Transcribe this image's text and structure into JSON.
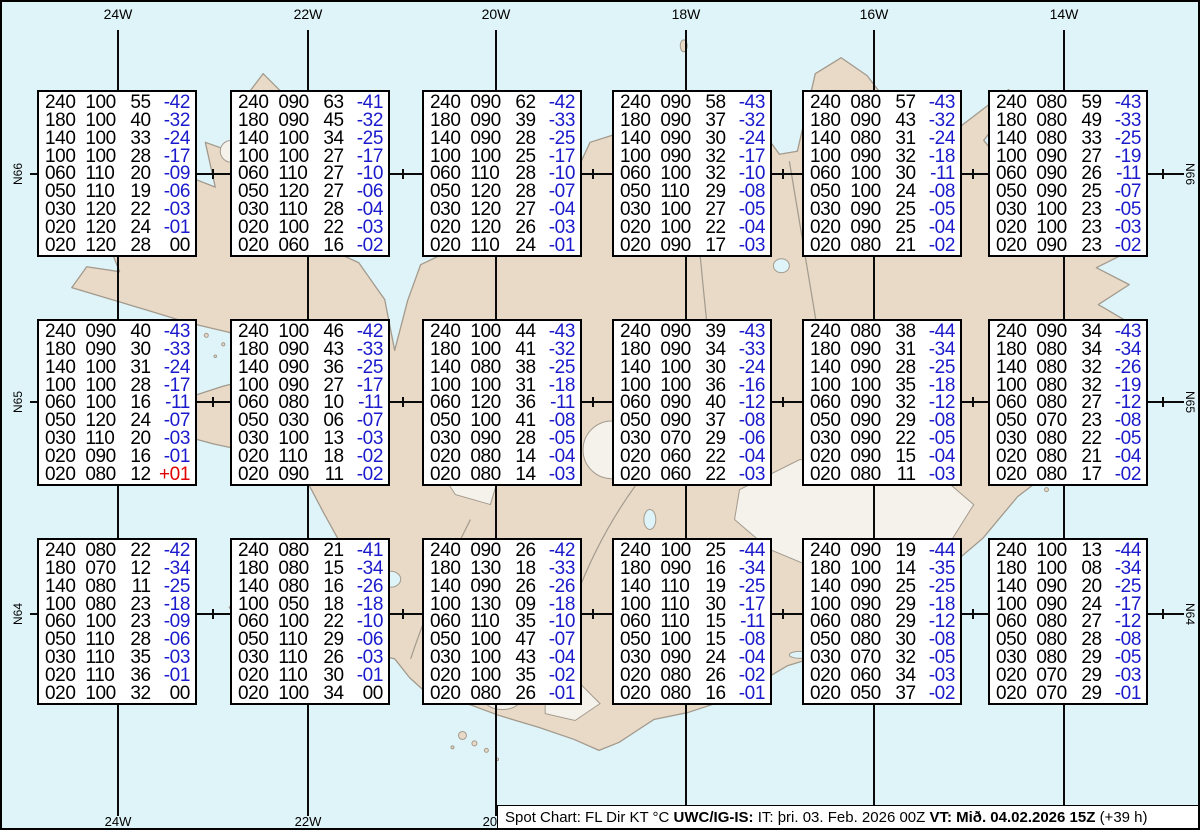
{
  "map": {
    "ocean_color": "#dff4f8",
    "land_color": "#e8dac6",
    "coast_color": "#a39a8e",
    "graticule_color": "#0a0a0a",
    "meridians": [
      {
        "label": "24W",
        "x": 116
      },
      {
        "label": "22W",
        "x": 306
      },
      {
        "label": "20W",
        "x": 494
      },
      {
        "label": "18W",
        "x": 684
      },
      {
        "label": "16W",
        "x": 872
      },
      {
        "label": "14W",
        "x": 1062
      }
    ],
    "parallels": [
      {
        "label": "N66",
        "y": 172
      },
      {
        "label": "N65",
        "y": 400
      },
      {
        "label": "N64",
        "y": 612
      }
    ],
    "parallel_tick_x": [
      57,
      211,
      401,
      591,
      781,
      971,
      1161
    ],
    "grid_col_x": [
      35,
      228,
      420,
      610,
      800,
      986
    ],
    "grid_row_y": [
      88,
      317,
      536
    ]
  },
  "colors": {
    "temp_negative": "#1a1acc",
    "temp_positive": "#e00000",
    "temp_zero": "#000000"
  },
  "footer": {
    "segments": [
      {
        "text": "Spot Chart: FL Dir KT °C ",
        "bold": false
      },
      {
        "text": "UWC/IG-IS: ",
        "bold": true
      },
      {
        "text": "IT: þri. 03. Feb. 2026 00Z ",
        "bold": false
      },
      {
        "text": "VT: Mið. 04.02.2026 15Z ",
        "bold": true
      },
      {
        "text": "(+39 h)",
        "bold": false
      }
    ]
  },
  "columns_meaning": [
    "FL",
    "Dir",
    "KT",
    "°C"
  ],
  "spot_boxes": [
    {
      "row": 0,
      "col": 0,
      "rows": [
        [
          "240",
          "100",
          "55",
          "-42"
        ],
        [
          "180",
          "100",
          "40",
          "-32"
        ],
        [
          "140",
          "100",
          "33",
          "-24"
        ],
        [
          "100",
          "100",
          "28",
          "-17"
        ],
        [
          "060",
          "110",
          "20",
          "-09"
        ],
        [
          "050",
          "110",
          "19",
          "-06"
        ],
        [
          "030",
          "120",
          "22",
          "-03"
        ],
        [
          "020",
          "120",
          "24",
          "-01"
        ],
        [
          "020",
          "120",
          "28",
          "00"
        ]
      ]
    },
    {
      "row": 0,
      "col": 1,
      "rows": [
        [
          "240",
          "090",
          "63",
          "-41"
        ],
        [
          "180",
          "090",
          "45",
          "-32"
        ],
        [
          "140",
          "100",
          "34",
          "-25"
        ],
        [
          "100",
          "100",
          "27",
          "-17"
        ],
        [
          "060",
          "110",
          "27",
          "-10"
        ],
        [
          "050",
          "120",
          "27",
          "-06"
        ],
        [
          "030",
          "110",
          "28",
          "-04"
        ],
        [
          "020",
          "100",
          "22",
          "-03"
        ],
        [
          "020",
          "060",
          "16",
          "-02"
        ]
      ]
    },
    {
      "row": 0,
      "col": 2,
      "rows": [
        [
          "240",
          "090",
          "62",
          "-42"
        ],
        [
          "180",
          "090",
          "39",
          "-33"
        ],
        [
          "140",
          "090",
          "28",
          "-25"
        ],
        [
          "100",
          "100",
          "25",
          "-17"
        ],
        [
          "060",
          "110",
          "28",
          "-10"
        ],
        [
          "050",
          "120",
          "28",
          "-07"
        ],
        [
          "030",
          "120",
          "27",
          "-04"
        ],
        [
          "020",
          "120",
          "26",
          "-03"
        ],
        [
          "020",
          "110",
          "24",
          "-01"
        ]
      ]
    },
    {
      "row": 0,
      "col": 3,
      "rows": [
        [
          "240",
          "090",
          "58",
          "-43"
        ],
        [
          "180",
          "090",
          "37",
          "-32"
        ],
        [
          "140",
          "090",
          "30",
          "-24"
        ],
        [
          "100",
          "090",
          "32",
          "-17"
        ],
        [
          "060",
          "100",
          "32",
          "-10"
        ],
        [
          "050",
          "110",
          "29",
          "-08"
        ],
        [
          "030",
          "100",
          "27",
          "-05"
        ],
        [
          "020",
          "100",
          "22",
          "-04"
        ],
        [
          "020",
          "090",
          "17",
          "-03"
        ]
      ]
    },
    {
      "row": 0,
      "col": 4,
      "rows": [
        [
          "240",
          "080",
          "57",
          "-43"
        ],
        [
          "180",
          "090",
          "43",
          "-32"
        ],
        [
          "140",
          "080",
          "31",
          "-24"
        ],
        [
          "100",
          "090",
          "32",
          "-18"
        ],
        [
          "060",
          "100",
          "30",
          "-11"
        ],
        [
          "050",
          "100",
          "24",
          "-08"
        ],
        [
          "030",
          "090",
          "25",
          "-05"
        ],
        [
          "020",
          "090",
          "25",
          "-04"
        ],
        [
          "020",
          "080",
          "21",
          "-02"
        ]
      ]
    },
    {
      "row": 0,
      "col": 5,
      "rows": [
        [
          "240",
          "080",
          "59",
          "-43"
        ],
        [
          "180",
          "080",
          "49",
          "-33"
        ],
        [
          "140",
          "080",
          "33",
          "-25"
        ],
        [
          "100",
          "090",
          "27",
          "-19"
        ],
        [
          "060",
          "090",
          "26",
          "-11"
        ],
        [
          "050",
          "090",
          "25",
          "-07"
        ],
        [
          "030",
          "100",
          "23",
          "-05"
        ],
        [
          "020",
          "100",
          "23",
          "-03"
        ],
        [
          "020",
          "090",
          "23",
          "-02"
        ]
      ]
    },
    {
      "row": 1,
      "col": 0,
      "rows": [
        [
          "240",
          "090",
          "40",
          "-43"
        ],
        [
          "180",
          "090",
          "30",
          "-33"
        ],
        [
          "140",
          "100",
          "31",
          "-24"
        ],
        [
          "100",
          "100",
          "28",
          "-17"
        ],
        [
          "060",
          "100",
          "16",
          "-11"
        ],
        [
          "050",
          "120",
          "24",
          "-07"
        ],
        [
          "030",
          "110",
          "20",
          "-03"
        ],
        [
          "020",
          "090",
          "16",
          "-01"
        ],
        [
          "020",
          "080",
          "12",
          "+01"
        ]
      ]
    },
    {
      "row": 1,
      "col": 1,
      "rows": [
        [
          "240",
          "100",
          "46",
          "-42"
        ],
        [
          "180",
          "090",
          "43",
          "-33"
        ],
        [
          "140",
          "090",
          "36",
          "-25"
        ],
        [
          "100",
          "090",
          "27",
          "-17"
        ],
        [
          "060",
          "080",
          "10",
          "-11"
        ],
        [
          "050",
          "030",
          "06",
          "-07"
        ],
        [
          "030",
          "100",
          "13",
          "-03"
        ],
        [
          "020",
          "110",
          "18",
          "-02"
        ],
        [
          "020",
          "090",
          "11",
          "-02"
        ]
      ]
    },
    {
      "row": 1,
      "col": 2,
      "rows": [
        [
          "240",
          "100",
          "44",
          "-43"
        ],
        [
          "180",
          "100",
          "41",
          "-32"
        ],
        [
          "140",
          "080",
          "38",
          "-25"
        ],
        [
          "100",
          "100",
          "31",
          "-18"
        ],
        [
          "060",
          "120",
          "36",
          "-11"
        ],
        [
          "050",
          "100",
          "41",
          "-08"
        ],
        [
          "030",
          "090",
          "28",
          "-05"
        ],
        [
          "020",
          "080",
          "14",
          "-04"
        ],
        [
          "020",
          "080",
          "14",
          "-03"
        ]
      ]
    },
    {
      "row": 1,
      "col": 3,
      "rows": [
        [
          "240",
          "090",
          "39",
          "-43"
        ],
        [
          "180",
          "090",
          "34",
          "-33"
        ],
        [
          "140",
          "100",
          "30",
          "-24"
        ],
        [
          "100",
          "100",
          "36",
          "-16"
        ],
        [
          "060",
          "090",
          "40",
          "-12"
        ],
        [
          "050",
          "090",
          "37",
          "-08"
        ],
        [
          "030",
          "070",
          "29",
          "-06"
        ],
        [
          "020",
          "060",
          "22",
          "-04"
        ],
        [
          "020",
          "060",
          "22",
          "-03"
        ]
      ]
    },
    {
      "row": 1,
      "col": 4,
      "rows": [
        [
          "240",
          "080",
          "38",
          "-44"
        ],
        [
          "180",
          "090",
          "31",
          "-34"
        ],
        [
          "140",
          "090",
          "28",
          "-25"
        ],
        [
          "100",
          "100",
          "35",
          "-18"
        ],
        [
          "060",
          "090",
          "32",
          "-12"
        ],
        [
          "050",
          "090",
          "29",
          "-08"
        ],
        [
          "030",
          "090",
          "22",
          "-05"
        ],
        [
          "020",
          "090",
          "15",
          "-04"
        ],
        [
          "020",
          "080",
          "11",
          "-03"
        ]
      ]
    },
    {
      "row": 1,
      "col": 5,
      "rows": [
        [
          "240",
          "090",
          "34",
          "-43"
        ],
        [
          "180",
          "080",
          "34",
          "-34"
        ],
        [
          "140",
          "080",
          "32",
          "-26"
        ],
        [
          "100",
          "080",
          "32",
          "-19"
        ],
        [
          "060",
          "080",
          "27",
          "-12"
        ],
        [
          "050",
          "070",
          "23",
          "-08"
        ],
        [
          "030",
          "080",
          "22",
          "-05"
        ],
        [
          "020",
          "080",
          "21",
          "-04"
        ],
        [
          "020",
          "080",
          "17",
          "-02"
        ]
      ]
    },
    {
      "row": 2,
      "col": 0,
      "rows": [
        [
          "240",
          "080",
          "22",
          "-42"
        ],
        [
          "180",
          "070",
          "12",
          "-34"
        ],
        [
          "140",
          "080",
          "11",
          "-25"
        ],
        [
          "100",
          "080",
          "23",
          "-18"
        ],
        [
          "060",
          "100",
          "23",
          "-09"
        ],
        [
          "050",
          "110",
          "28",
          "-06"
        ],
        [
          "030",
          "110",
          "35",
          "-03"
        ],
        [
          "020",
          "110",
          "36",
          "-01"
        ],
        [
          "020",
          "100",
          "32",
          "00"
        ]
      ]
    },
    {
      "row": 2,
      "col": 1,
      "rows": [
        [
          "240",
          "080",
          "21",
          "-41"
        ],
        [
          "180",
          "080",
          "15",
          "-34"
        ],
        [
          "140",
          "080",
          "16",
          "-26"
        ],
        [
          "100",
          "050",
          "18",
          "-18"
        ],
        [
          "060",
          "100",
          "22",
          "-10"
        ],
        [
          "050",
          "110",
          "29",
          "-06"
        ],
        [
          "030",
          "110",
          "26",
          "-03"
        ],
        [
          "020",
          "110",
          "30",
          "-01"
        ],
        [
          "020",
          "100",
          "34",
          "00"
        ]
      ]
    },
    {
      "row": 2,
      "col": 2,
      "rows": [
        [
          "240",
          "090",
          "26",
          "-42"
        ],
        [
          "180",
          "130",
          "18",
          "-33"
        ],
        [
          "140",
          "090",
          "26",
          "-26"
        ],
        [
          "100",
          "130",
          "09",
          "-18"
        ],
        [
          "060",
          "110",
          "35",
          "-10"
        ],
        [
          "050",
          "100",
          "47",
          "-07"
        ],
        [
          "030",
          "100",
          "43",
          "-04"
        ],
        [
          "020",
          "100",
          "35",
          "-02"
        ],
        [
          "020",
          "080",
          "26",
          "-01"
        ]
      ]
    },
    {
      "row": 2,
      "col": 3,
      "rows": [
        [
          "240",
          "100",
          "25",
          "-44"
        ],
        [
          "180",
          "090",
          "16",
          "-34"
        ],
        [
          "140",
          "110",
          "19",
          "-25"
        ],
        [
          "100",
          "110",
          "30",
          "-17"
        ],
        [
          "060",
          "110",
          "15",
          "-11"
        ],
        [
          "050",
          "100",
          "15",
          "-08"
        ],
        [
          "030",
          "090",
          "24",
          "-04"
        ],
        [
          "020",
          "080",
          "26",
          "-02"
        ],
        [
          "020",
          "080",
          "16",
          "-01"
        ]
      ]
    },
    {
      "row": 2,
      "col": 4,
      "rows": [
        [
          "240",
          "090",
          "19",
          "-44"
        ],
        [
          "180",
          "100",
          "14",
          "-35"
        ],
        [
          "140",
          "090",
          "25",
          "-25"
        ],
        [
          "100",
          "090",
          "29",
          "-18"
        ],
        [
          "060",
          "080",
          "29",
          "-12"
        ],
        [
          "050",
          "080",
          "30",
          "-08"
        ],
        [
          "030",
          "070",
          "32",
          "-05"
        ],
        [
          "020",
          "060",
          "34",
          "-03"
        ],
        [
          "020",
          "050",
          "37",
          "-02"
        ]
      ]
    },
    {
      "row": 2,
      "col": 5,
      "rows": [
        [
          "240",
          "100",
          "13",
          "-44"
        ],
        [
          "180",
          "100",
          "08",
          "-34"
        ],
        [
          "140",
          "090",
          "20",
          "-25"
        ],
        [
          "100",
          "090",
          "24",
          "-17"
        ],
        [
          "060",
          "080",
          "27",
          "-12"
        ],
        [
          "050",
          "080",
          "28",
          "-08"
        ],
        [
          "030",
          "080",
          "29",
          "-05"
        ],
        [
          "020",
          "070",
          "29",
          "-03"
        ],
        [
          "020",
          "070",
          "29",
          "-01"
        ]
      ]
    }
  ]
}
